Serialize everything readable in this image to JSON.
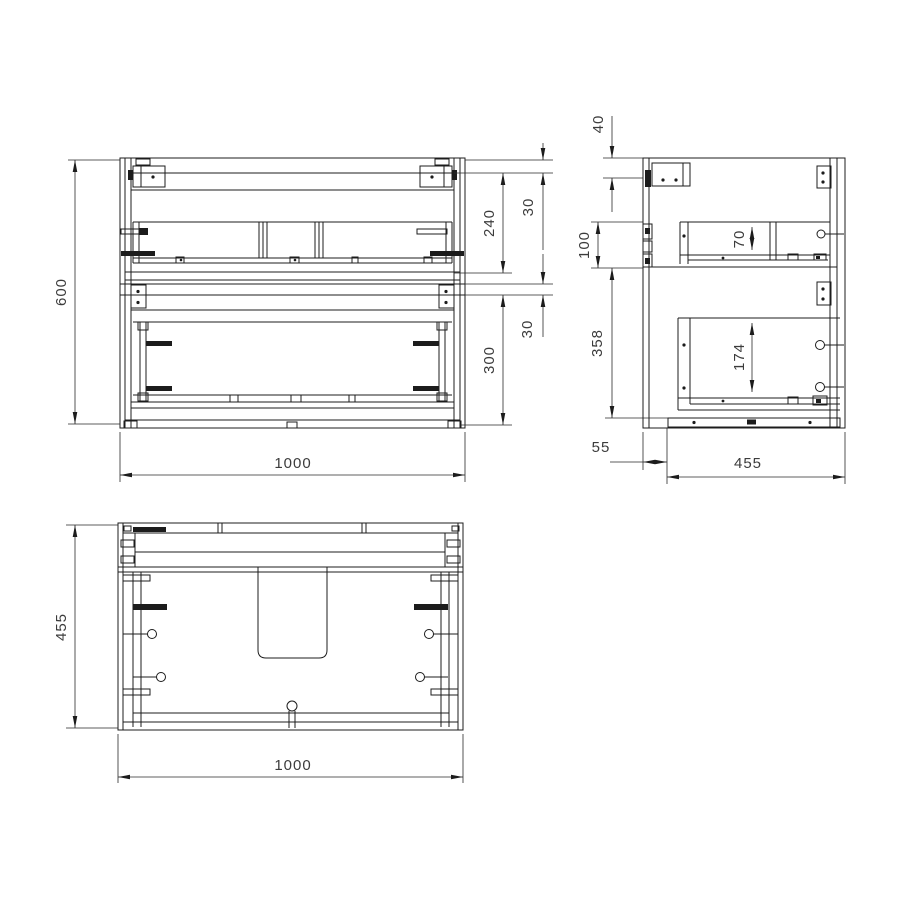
{
  "drawing": {
    "type": "technical-orthographic-drawing",
    "subject": "wall-hung two-drawer vanity cabinet",
    "colors": {
      "line": "#1c1c1c",
      "dim_text": "#3c3c3c",
      "background": "#ffffff"
    },
    "front": {
      "height": "600",
      "width": "1000",
      "gap_top": "30",
      "drawer_top": "240",
      "gap_mid": "30",
      "drawer_bottom": "300"
    },
    "side": {
      "rail": "40",
      "upper_zone": "100",
      "lower_zone": "358",
      "recess": "55",
      "depth": "455",
      "drawer_top_inner": "70",
      "drawer_bottom_inner": "174"
    },
    "plan": {
      "depth": "455",
      "width": "1000"
    }
  }
}
